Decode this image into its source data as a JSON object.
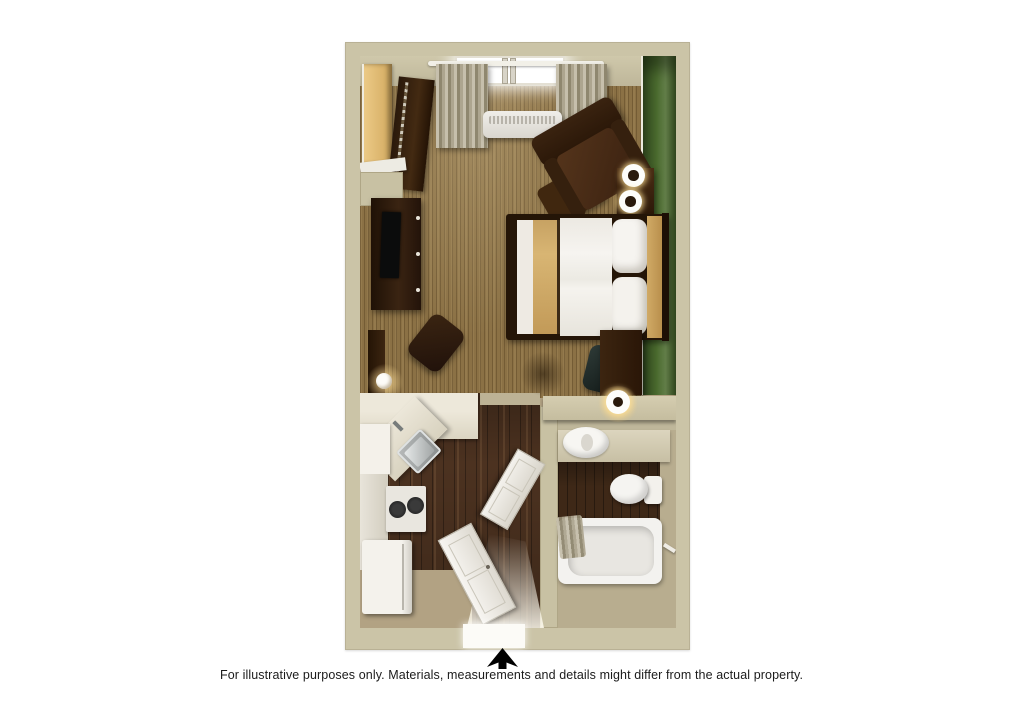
{
  "page": {
    "background": "#ffffff"
  },
  "floorplan": {
    "type": "3d-top-down-floorplan",
    "palette": {
      "outer_wall": "#cbc4a7",
      "accent_wall_green": "#44622c",
      "carpet": "#8b7145",
      "hardwood": "#4c3220",
      "vinyl_floor": "#b2a283",
      "dark_wood_furniture": "#33200f",
      "closet_wood": "#e0ba77",
      "linens_white": "#f3f1ec",
      "bed_runner_tan": "#d2ae6e",
      "fixture_white": "#f2f1ee"
    },
    "rooms": [
      {
        "id": "living-sleeping-area",
        "floor": "carpet"
      },
      {
        "id": "closet",
        "floor": "carpet"
      },
      {
        "id": "kitchen",
        "floor": "hardwood"
      },
      {
        "id": "entry-hallway",
        "floor": "hardwood"
      },
      {
        "id": "bathroom",
        "floor": "hardwood-and-vinyl"
      }
    ],
    "furniture": [
      "closet-shelves",
      "hanging-clothes",
      "window",
      "curtains",
      "curtain-rod",
      "ptac-ac-unit",
      "armchair",
      "ottoman",
      "nightstand",
      "spiral-table-lamps",
      "queen-bed",
      "pillows",
      "headboard",
      "media-dresser",
      "television",
      "lounge-chair",
      "floor-lamp",
      "desk",
      "desk-chair",
      "accent-lamp",
      "kitchen-counter",
      "corner-sink",
      "cooktop",
      "refrigerator",
      "cabinets",
      "entry-door",
      "bathroom-door",
      "vanity-counter",
      "vanity-sink",
      "toilet",
      "bathtub",
      "shower-curtain",
      "towel-bar"
    ]
  },
  "footer": {
    "north_arrow": "up",
    "disclaimer": "For illustrative purposes only.  Materials, measurements and details might differ from the actual property."
  }
}
